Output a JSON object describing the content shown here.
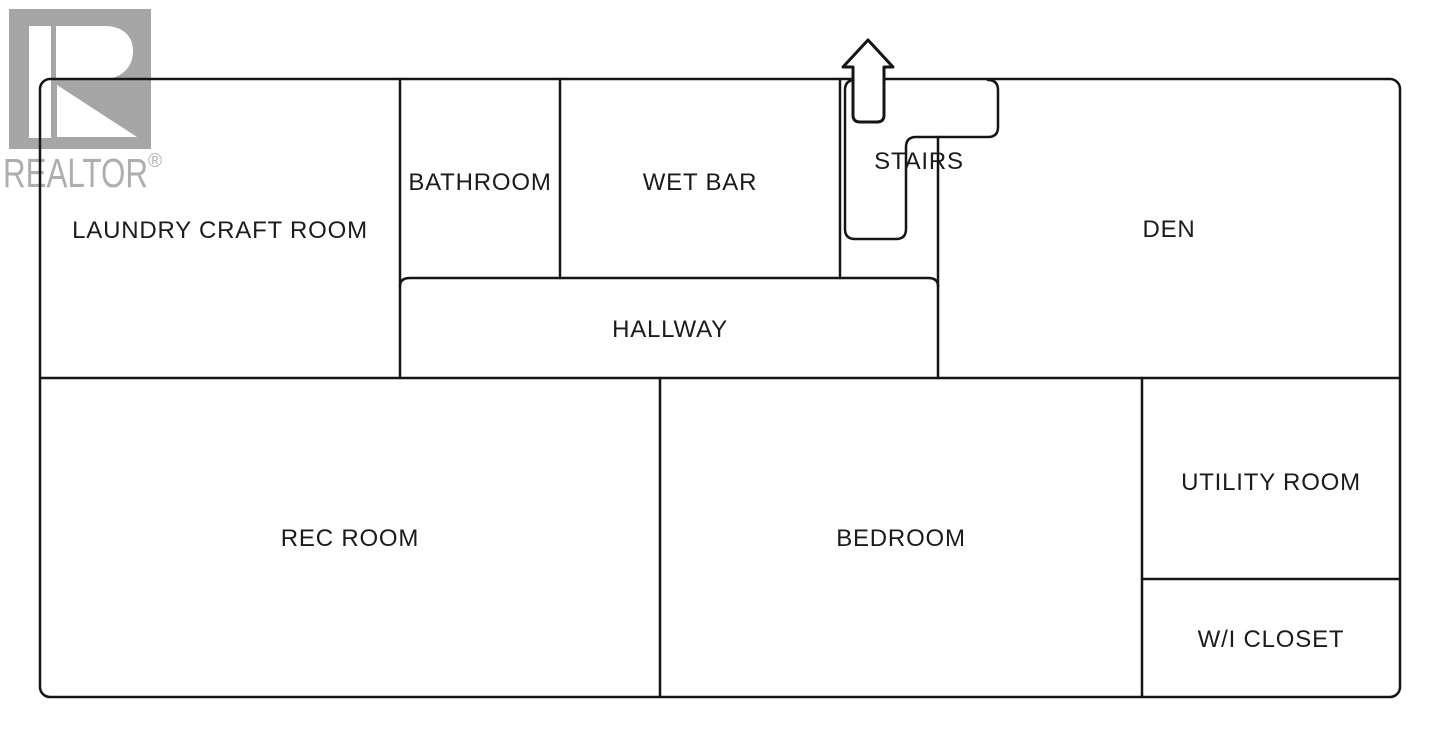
{
  "branding": {
    "logo_text": "REALTOR",
    "registered_mark": "®"
  },
  "floorplan": {
    "rooms": [
      {
        "id": "laundry-craft-room",
        "label": "LAUNDRY CRAFT ROOM"
      },
      {
        "id": "bathroom",
        "label": "BATHROOM"
      },
      {
        "id": "wet-bar",
        "label": "WET BAR"
      },
      {
        "id": "stairs",
        "label": "STAIRS"
      },
      {
        "id": "den",
        "label": "DEN"
      },
      {
        "id": "hallway",
        "label": "HALLWAY"
      },
      {
        "id": "rec-room",
        "label": "REC ROOM"
      },
      {
        "id": "bedroom",
        "label": "BEDROOM"
      },
      {
        "id": "utility-room",
        "label": "UTILITY ROOM"
      },
      {
        "id": "wi-closet",
        "label": "W/I CLOSET"
      }
    ]
  },
  "colors": {
    "background": "#ffffff",
    "wall": "#151515",
    "label": "#1b1b1b",
    "logo_box": "#a6a6a6",
    "logo_text": "#aeaeae"
  }
}
